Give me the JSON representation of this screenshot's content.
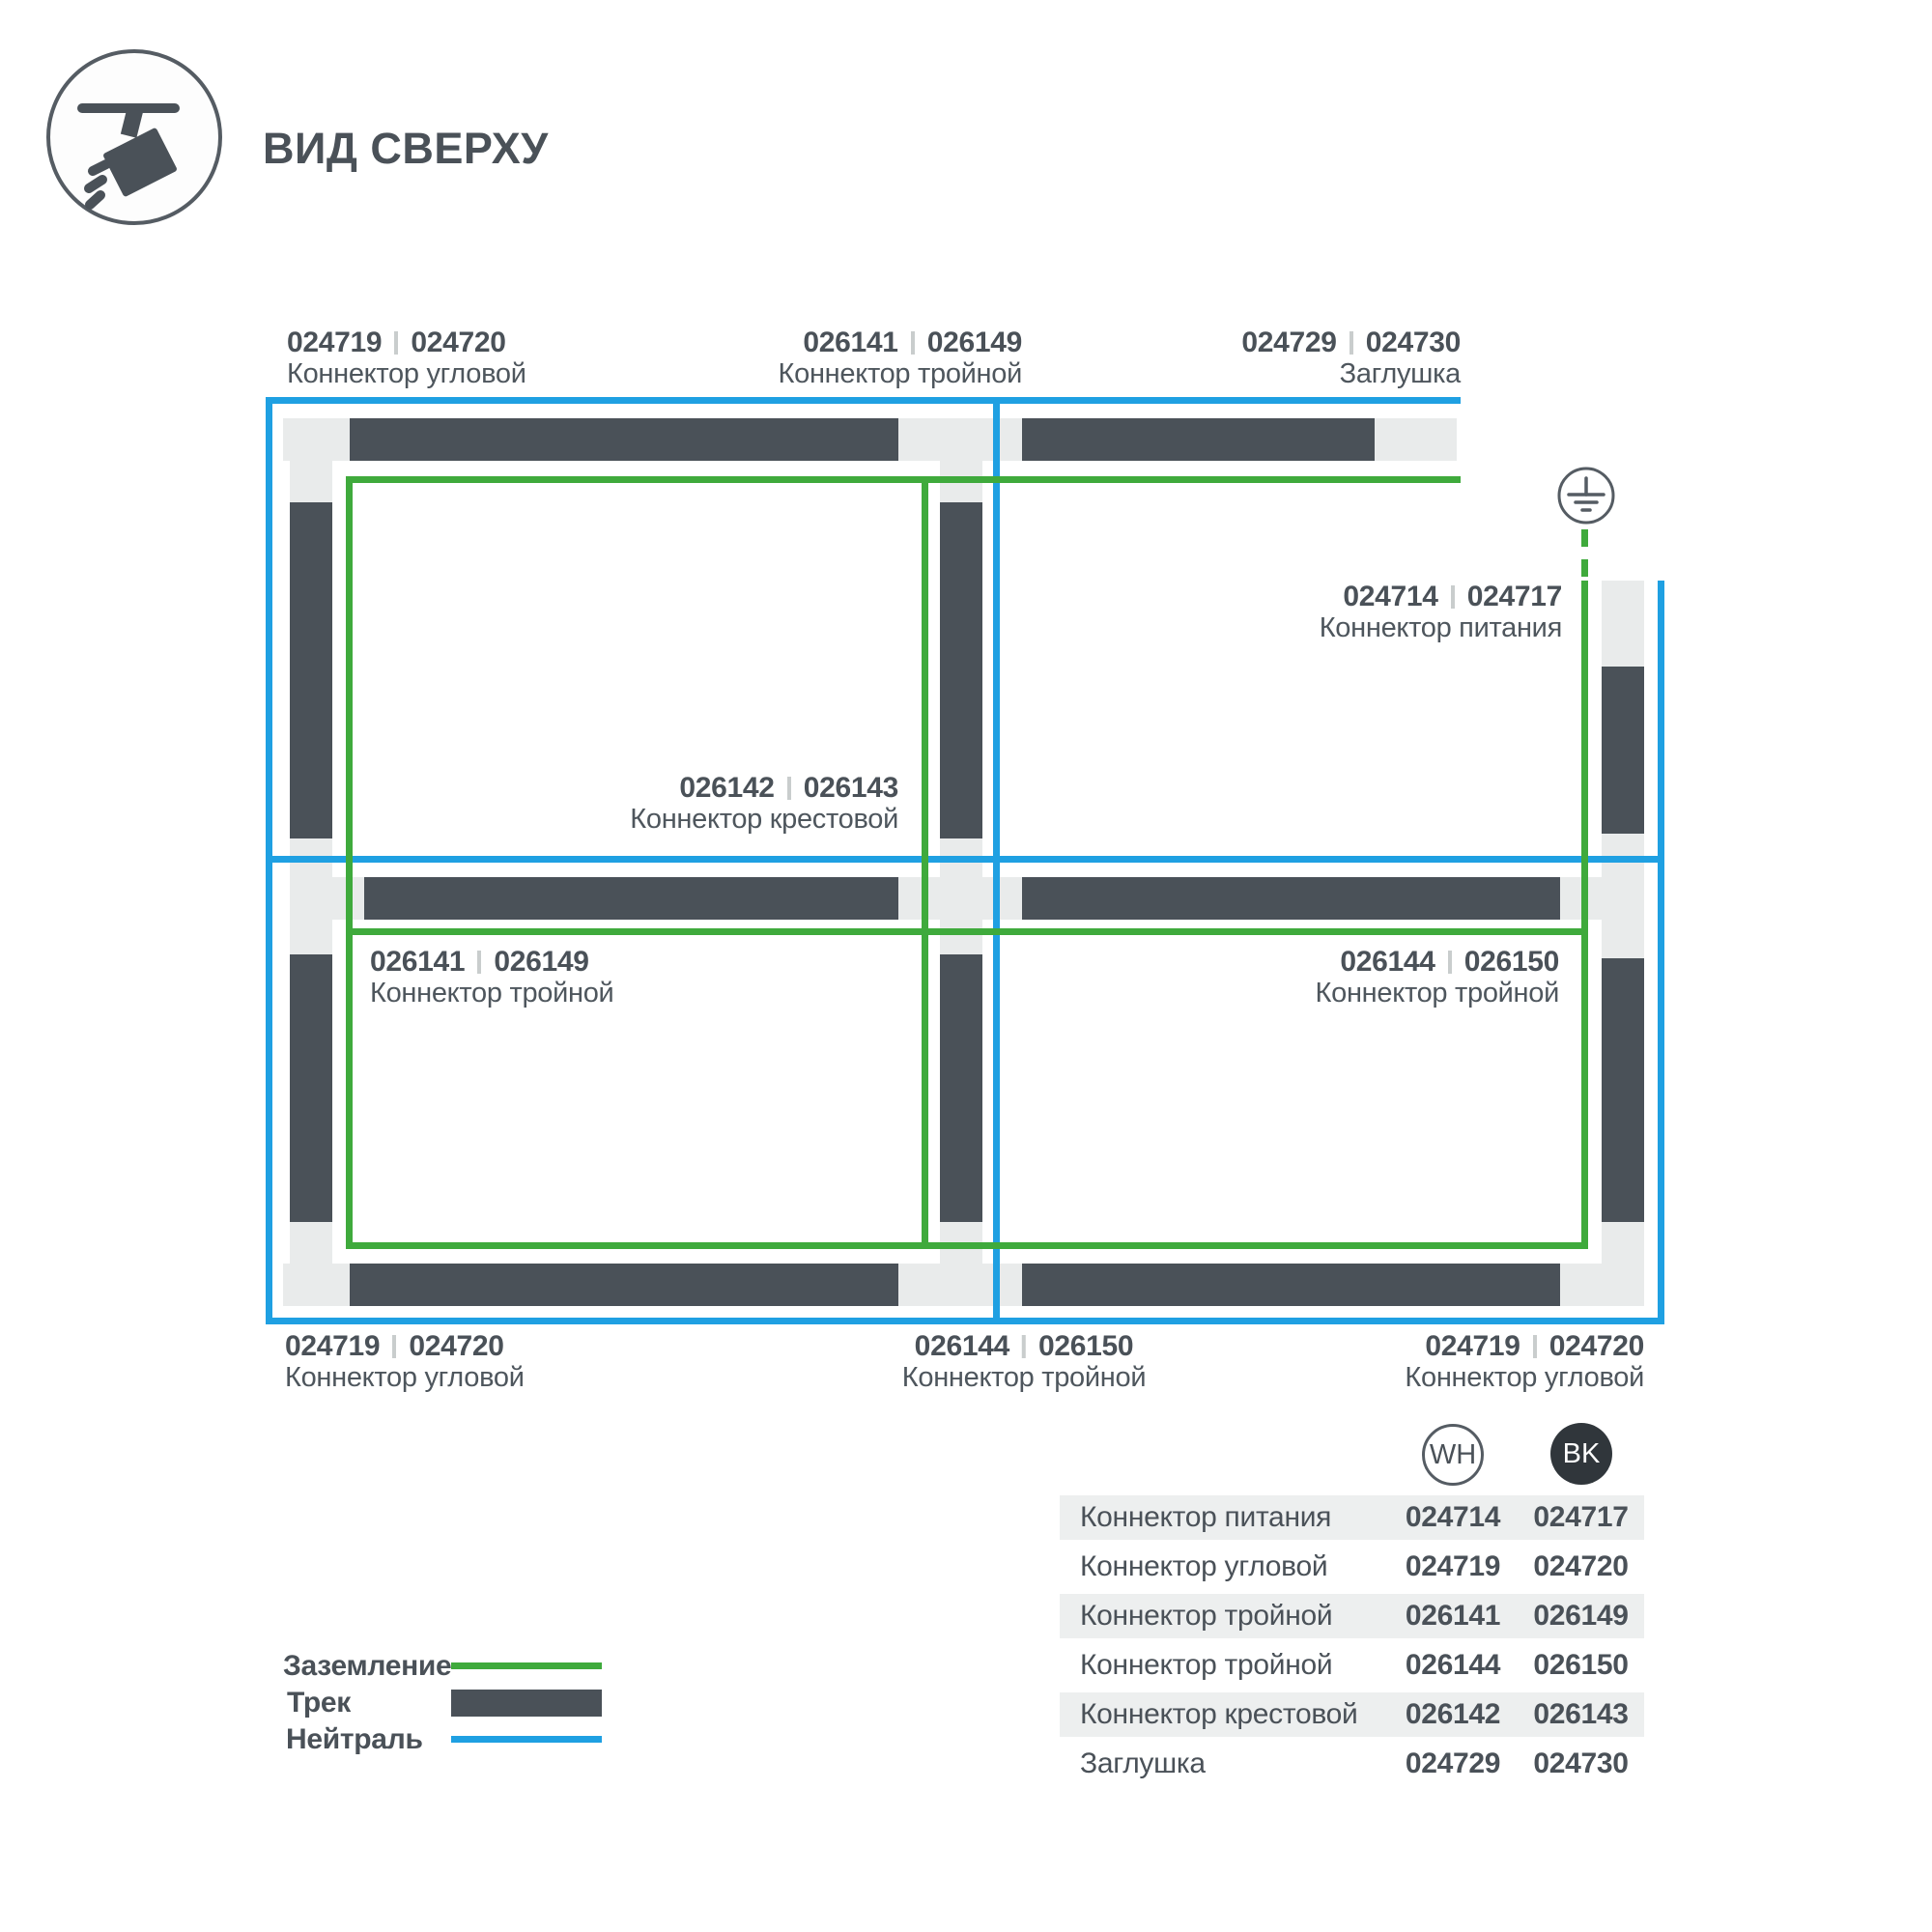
{
  "header": {
    "title": "ВИД СВЕРХУ",
    "icon": "track-spotlight-icon"
  },
  "colors": {
    "track": "#4A5158",
    "connector": "#E9EBEB",
    "ground_green": "#3FAA3C",
    "neutral_blue": "#1FA0E2",
    "text": "#4A5158",
    "row_shade": "#EDEFEF",
    "separator": "#C9CDCD",
    "bk_fill": "#30363B"
  },
  "diagram": {
    "ground_symbol": "earth-ground-icon",
    "labels": [
      {
        "id": "corner-top-left",
        "wh": "024719",
        "bk": "024720",
        "name": "Коннектор угловой"
      },
      {
        "id": "tee-top",
        "wh": "026141",
        "bk": "026149",
        "name": "Коннектор тройной"
      },
      {
        "id": "endcap-top-right",
        "wh": "024729",
        "bk": "024730",
        "name": "Заглушка"
      },
      {
        "id": "power-feed-right",
        "wh": "024714",
        "bk": "024717",
        "name": "Коннектор питания"
      },
      {
        "id": "cross-center",
        "wh": "026142",
        "bk": "026143",
        "name": "Коннектор крестовой"
      },
      {
        "id": "tee-left",
        "wh": "026141",
        "bk": "026149",
        "name": "Коннектор тройной"
      },
      {
        "id": "tee-right",
        "wh": "026144",
        "bk": "026150",
        "name": "Коннектор тройной"
      },
      {
        "id": "corner-bottom-left",
        "wh": "024719",
        "bk": "024720",
        "name": "Коннектор угловой"
      },
      {
        "id": "tee-bottom",
        "wh": "026144",
        "bk": "026150",
        "name": "Коннектор тройной"
      },
      {
        "id": "corner-bottom-right",
        "wh": "024719",
        "bk": "024720",
        "name": "Коннектор угловой"
      }
    ]
  },
  "legend": {
    "items": [
      {
        "label": "Заземление",
        "swatch": "green-line"
      },
      {
        "label": "Трек",
        "swatch": "track-bar"
      },
      {
        "label": "Нейтраль",
        "swatch": "blue-line"
      }
    ]
  },
  "table": {
    "columns": [
      {
        "code": "WH"
      },
      {
        "code": "BK"
      }
    ],
    "rows": [
      {
        "label": "Коннектор питания",
        "wh": "024714",
        "bk": "024717"
      },
      {
        "label": "Коннектор угловой",
        "wh": "024719",
        "bk": "024720"
      },
      {
        "label": "Коннектор тройной",
        "wh": "026141",
        "bk": "026149"
      },
      {
        "label": "Коннектор тройной",
        "wh": "026144",
        "bk": "026150"
      },
      {
        "label": "Коннектор крестовой",
        "wh": "026142",
        "bk": "026143"
      },
      {
        "label": "Заглушка",
        "wh": "024729",
        "bk": "024730"
      }
    ]
  }
}
